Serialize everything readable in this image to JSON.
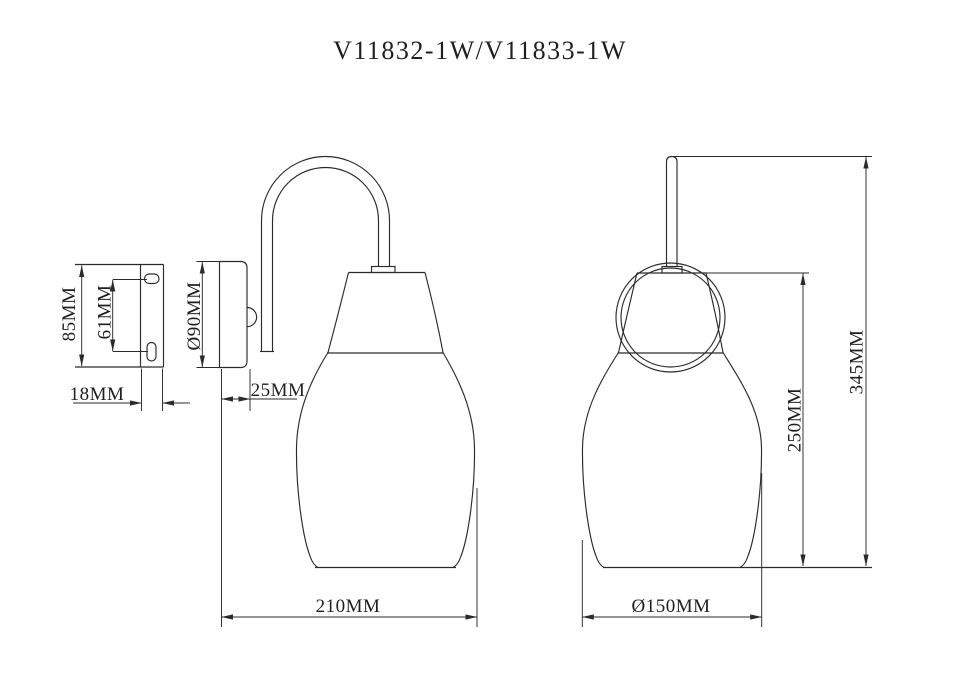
{
  "title": "V11832-1W/V11833-1W",
  "drawing": {
    "bracket_view": {
      "height_label": "85MM",
      "hole_spacing_label": "61MM",
      "depth_label": "18MM"
    },
    "side_view": {
      "backplate_diameter_label": "Ø90MM",
      "backplate_depth_label": "25MM",
      "projection_label": "210MM"
    },
    "front_view": {
      "shade_diameter_label": "Ø150MM",
      "shade_height_label": "250MM",
      "overall_height_label": "345MM"
    }
  },
  "colors": {
    "line": "#2b2b2b",
    "text": "#1f1f1f",
    "background": "#ffffff"
  }
}
